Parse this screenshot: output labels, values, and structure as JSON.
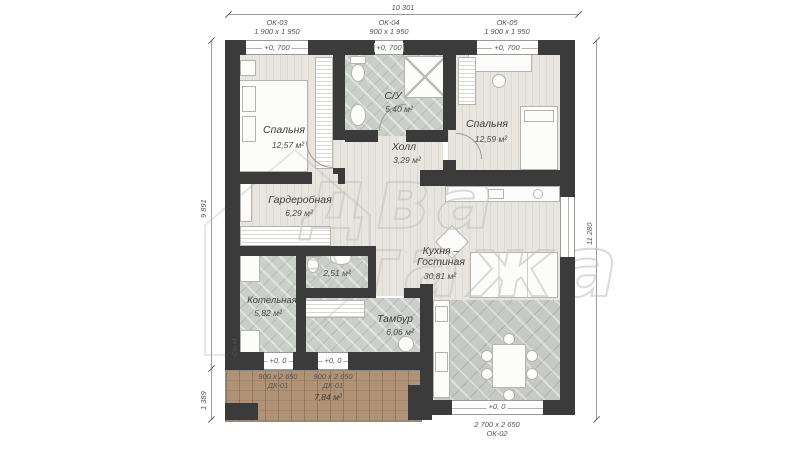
{
  "plan": {
    "dimensions": {
      "top": "10 301",
      "left_main": "9 891",
      "left_terrace": "1 389",
      "right": "11 280"
    },
    "openings": {
      "ok03": {
        "name": "ОК-03",
        "size": "1 900 x 1 950",
        "level": "+0, 700"
      },
      "ok04": {
        "name": "ОК-04",
        "size": "900 x 1 950",
        "level": "+0, 700"
      },
      "ok05": {
        "name": "ОК-05",
        "size": "1 900 x 1 950",
        "level": "+0, 700"
      },
      "ok02": {
        "name": "ОК-02",
        "size": "2 700 x 2 650",
        "level": "+0, 0"
      },
      "dk01": {
        "name": "ДК-01",
        "size": "900 x 2 650",
        "level": "+0, 0"
      }
    },
    "rooms": {
      "bedroom1": {
        "name": "Спальня",
        "area": "12,57 м²"
      },
      "su": {
        "name": "С/У",
        "area": "5,40 м²"
      },
      "bedroom2": {
        "name": "Спальня",
        "area": "12,59 м²"
      },
      "hall": {
        "name": "Холл",
        "area": "3,29 м²"
      },
      "wardrobe": {
        "name": "Гардеробная",
        "area": "6,29 м²"
      },
      "wc": {
        "area": "2,51 м²"
      },
      "boiler": {
        "name": "Котельная",
        "area": "5,82 м²"
      },
      "tambour": {
        "name": "Тамбур",
        "area": "6,06 м²"
      },
      "kitchen": {
        "name1": "Кухня –",
        "name2": "Гостиная",
        "area": "30,81 м²"
      },
      "terrace": {
        "area": "7,84 м²"
      }
    },
    "labels": {
      "washer": "Ст.М."
    },
    "watermark": {
      "line1": "два",
      "line2": "этажа"
    },
    "colors": {
      "wall": "#3b3b3b",
      "deck": "#b09377",
      "tile": "#cbcfca",
      "wood": "#e8e5df"
    }
  }
}
